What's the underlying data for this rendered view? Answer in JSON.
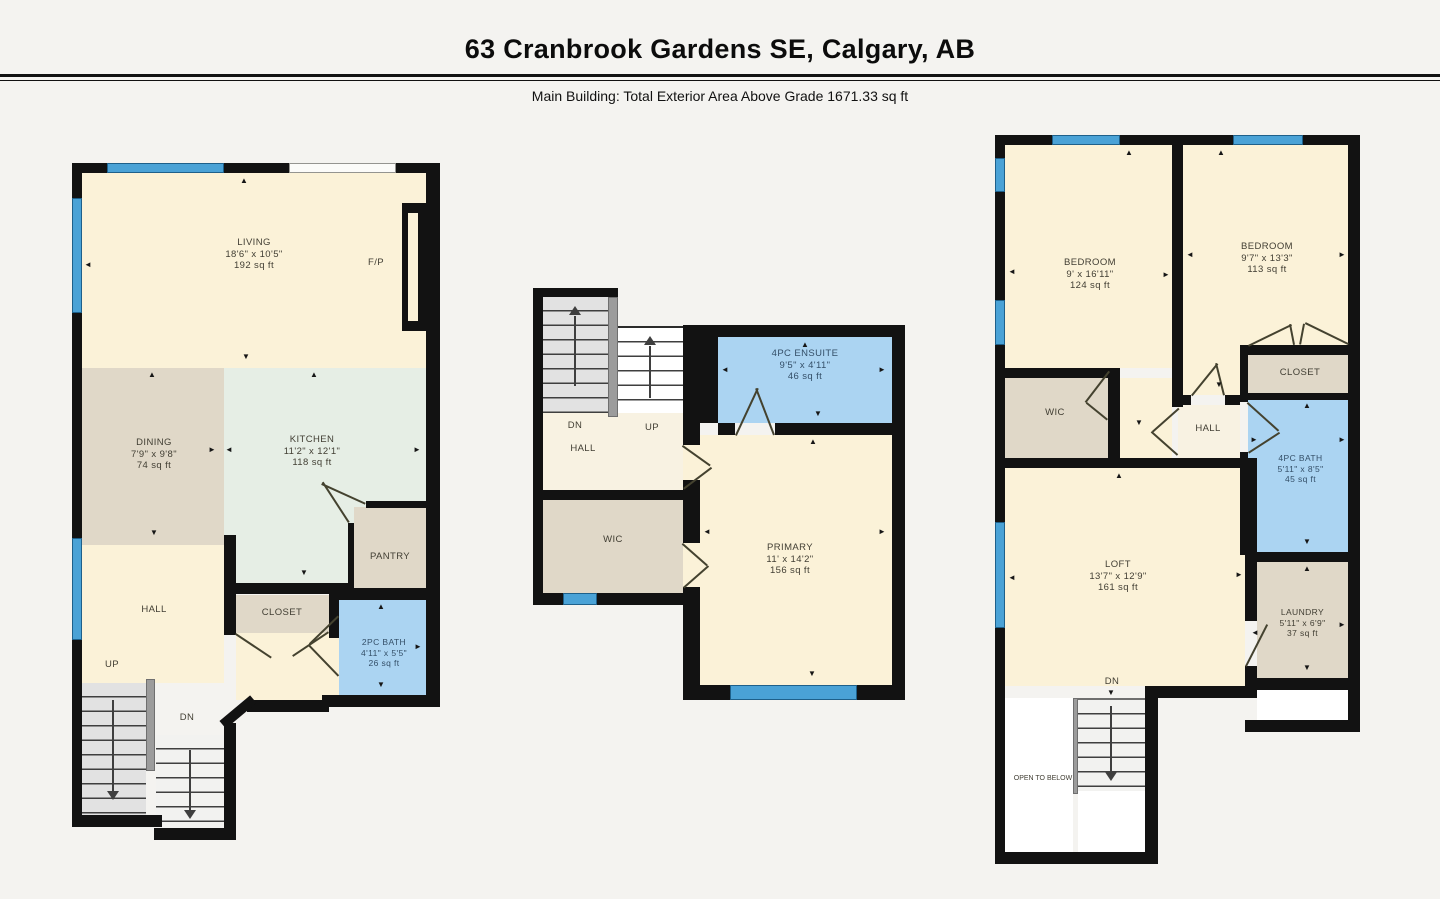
{
  "header": {
    "title": "63 Cranbrook Gardens SE, Calgary, AB",
    "subtitle": "Main Building: Total Exterior Area Above Grade 1671.33 sq ft"
  },
  "icons": {
    "arrow_up": "▲",
    "arrow_down": "▼",
    "arrow_left": "◄",
    "arrow_right": "►"
  },
  "colors": {
    "wall": "#121212",
    "room_cream": "#fbf2d8",
    "room_tan": "#e0d8c8",
    "kitchen_green": "#e6eee5",
    "bath_blue": "#abd4f2",
    "window_blue": "#4aa2d6"
  },
  "floors": {
    "main": {
      "living": {
        "name": "LIVING",
        "dims": "18'6\" x 10'5\"",
        "area": "192 sq ft"
      },
      "dining": {
        "name": "DINING",
        "dims": "7'9\" x 9'8\"",
        "area": "74 sq ft"
      },
      "kitchen": {
        "name": "KITCHEN",
        "dims": "11'2\" x 12'1\"",
        "area": "118 sq ft"
      },
      "pantry": {
        "name": "PANTRY"
      },
      "hall": {
        "name": "HALL"
      },
      "closet": {
        "name": "CLOSET"
      },
      "bath": {
        "name": "2PC BATH",
        "dims": "4'11\" x 5'5\"",
        "area": "26 sq ft"
      },
      "fireplace": {
        "name": "F/P"
      },
      "up": "UP",
      "dn": "DN"
    },
    "second": {
      "ensuite": {
        "name": "4PC ENSUITE",
        "dims": "9'5\" x 4'11\"",
        "area": "46 sq ft"
      },
      "primary": {
        "name": "PRIMARY",
        "dims": "11' x 14'2\"",
        "area": "156 sq ft"
      },
      "wic": {
        "name": "WIC"
      },
      "hall": {
        "name": "HALL"
      },
      "up": "UP",
      "dn": "DN"
    },
    "third": {
      "bedroom1": {
        "name": "BEDROOM",
        "dims": "9' x 16'11\"",
        "area": "124 sq ft"
      },
      "bedroom2": {
        "name": "BEDROOM",
        "dims": "9'7\" x 13'3\"",
        "area": "113 sq ft"
      },
      "wic": {
        "name": "WIC"
      },
      "closet": {
        "name": "CLOSET"
      },
      "hall": {
        "name": "HALL"
      },
      "bath": {
        "name": "4PC BATH",
        "dims": "5'11\" x 8'5\"",
        "area": "45 sq ft"
      },
      "loft": {
        "name": "LOFT",
        "dims": "13'7\" x 12'9\"",
        "area": "161 sq ft"
      },
      "laundry": {
        "name": "LAUNDRY",
        "dims": "5'11\" x 6'9\"",
        "area": "37 sq ft"
      },
      "dn": "DN",
      "open_below": "OPEN TO BELOW"
    }
  }
}
